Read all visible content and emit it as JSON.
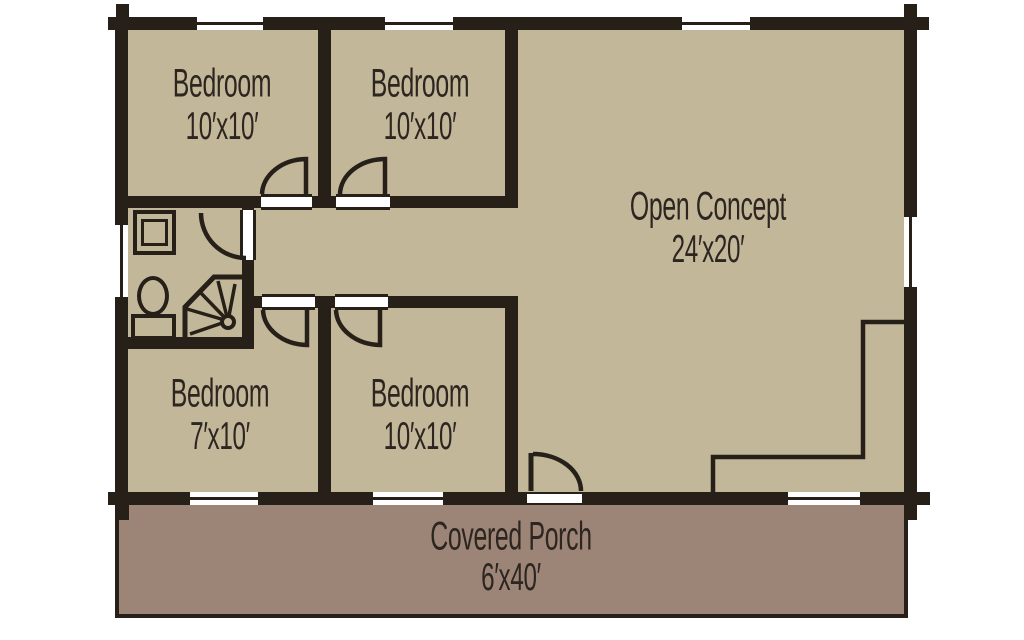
{
  "title": "Log cabin floor plan",
  "colors": {
    "floor": "#c3b79a",
    "porch": "#9c8476",
    "wall": "#262019",
    "text": "#2d2520",
    "background": "#ffffff"
  },
  "rooms": [
    {
      "name": "Bedroom",
      "dims": "10′x10′"
    },
    {
      "name": "Bedroom",
      "dims": "10′x10′"
    },
    {
      "name": "Open Concept",
      "dims": "24′x20′"
    },
    {
      "name": "Bedroom",
      "dims": "7′x10′"
    },
    {
      "name": "Bedroom",
      "dims": "10′x10′"
    },
    {
      "name": "Covered Porch",
      "dims": "6′x40′"
    }
  ],
  "fixtures": [
    "vanity-sink",
    "toilet",
    "corner-shower",
    "kitchen-counter"
  ],
  "openings": {
    "windows": 8,
    "interior-doors": 5,
    "exterior-doors": 1
  }
}
